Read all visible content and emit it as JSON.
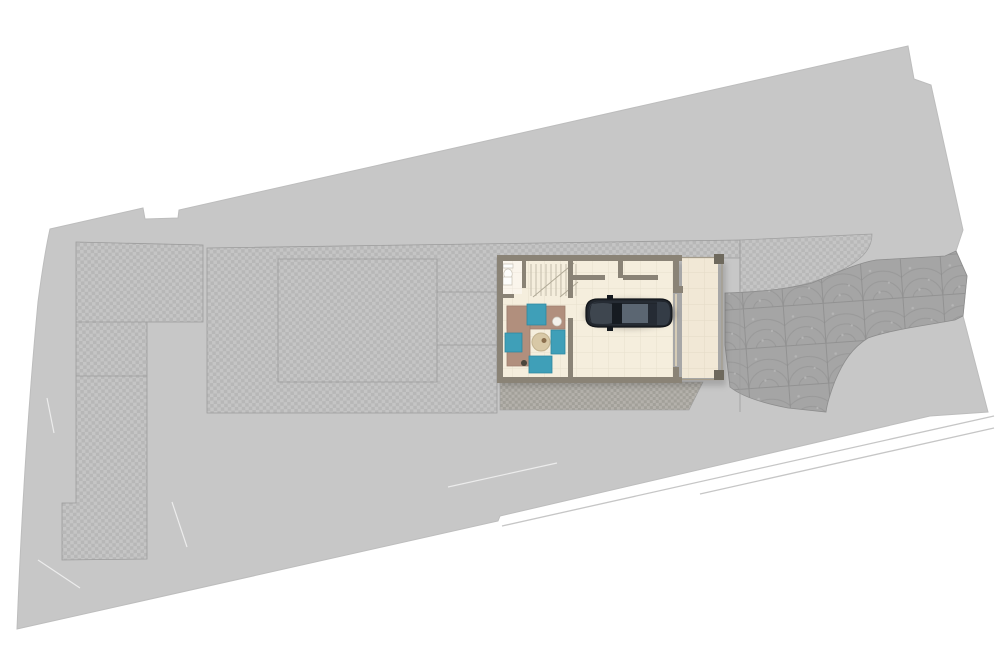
{
  "scene": {
    "width": 1000,
    "height": 666,
    "kind": "architectural-site-plan-top-view"
  },
  "colors": {
    "background": "#ffffff",
    "site": "#c7c7c7",
    "site_edge": "#bdbdbd",
    "paver_light": "#c5c5c5",
    "paver_dark": "#b7b7b7",
    "paver_strip_light": "#b3b0aa",
    "paver_strip_dark": "#a19e97",
    "cobble_base": "#a5a5a5",
    "cobble_line": "#8d8d8d",
    "cobble_dot": "#b5b5b5",
    "outline": "#9c9c9c",
    "sidewalk_line": "#c6c6c6",
    "scratch": "#efefef",
    "wall": "#8a8376",
    "floor": "#f5eedd",
    "floor_bath": "#faf5ec",
    "floor_carport": "#f1e8d6",
    "tile_line": "rgba(120,100,70,0.10)",
    "post": "#6e695d",
    "trim": "#a59d8c",
    "garage_door": "#d6ccb6",
    "stair_line": "#c3bcab",
    "stair_break": "#b0a996",
    "fixture_fill": "#fdfdfb",
    "fixture_stroke": "#c9c4b8",
    "shadow": "rgba(0,0,0,0.16)",
    "sofa": "#b18f7d",
    "sofa_edge": "#9d7f6e",
    "teal": "#3f9fb8",
    "teal_edge": "#2f87a0",
    "table": "#d8c8a6",
    "table_edge": "#c2b28f",
    "vase": "#f4f1ea",
    "accent_dark": "#4a463c",
    "deco": "#8b6f4e",
    "car_shadow": "rgba(0,0,0,0.22)",
    "car_body": "#21262d",
    "car_outline": "#121519",
    "car_inner": "#39414b",
    "car_hood": "#3e464f",
    "car_glass": "#161b21",
    "car_roof": "#5b6672",
    "car_rear_glass": "#252b34",
    "car_trunk": "#343c46",
    "car_mirror": "#14181d"
  },
  "geometry": {
    "site": "M50,229 L143,208 L145,219 L178,218 L179,210 L908,46 L914,79 L931,85 L963,230 L956,251 L967,276 L963,316 L988,412 L930,416 L500,516 L498,521 L17,629 Q24,450 38,302 Q44,256 50,229 Z",
    "paved_left": "M76,242 L203,245 L203,322 L147,322 L147,559 L62,560 L62,503 L76,503 Z",
    "paved_left_lines": "M76,322 L147,322 M76,376 L147,376",
    "paved_main": "M207,248 L740,240 L740,258 L497,258 L497,413 L207,413 Z",
    "paved_band_right": "M740,240 L872,234 C872,252 858,262 836,273 C812,285 772,292 740,293 Z",
    "paved_strip_garage": "M500,382 L703,382 L689,410 L500,410 Z",
    "cobble_driveway": "M725,293 C762,292 792,288 812,283 C838,272 858,263 876,260 L945,256 L956,251 L967,276 L963,316 L955,320 C922,326 890,330 868,338 C852,348 843,362 835,381 C830,394 827,404 826,412 L788,408 C762,403 741,396 730,387 L725,345 Z",
    "outline_inner_rect": "M278,259 L437,259 L437,382 L278,382 Z M437,292 L500,292 M437,345 L500,345",
    "outline_driveway_line": "M740,241 L740,412",
    "sidewalk_lines": "M502,526 L994,416 M700,494 L994,428",
    "scratch_lines": "M448,487 L557,463 M38,560 L80,588 M172,502 L187,547 M47,398 L54,433",
    "house_shadow": "M500,262 L726,262 L726,386 L500,386 Z",
    "floor_main": "M502,261 L673,261 L673,377 L502,377 Z",
    "floor_bath": "M503,261 L522,261 L522,294 L503,294 Z",
    "floor_carport": "M682,258 L718,258 L718,378 L682,378 Z",
    "carport_trim": "M682,257.5 L724,257.5 M722,257.5 L722,380 M682,379.5 L724,379.5",
    "carport_posts": "M714,254 L724,254 L724,264 L714,264 Z M714,370 L724,370 L724,380 L714,380 Z",
    "garage_door_line": "M676,294 L676,366",
    "stair_treads": "M531,264 L531,296 M536,264 L536,296 M541,264 L541,296 M546,264 L546,296 M551,264 L551,296 M556,264 L556,296 M561,264 L561,296 M566,264 L566,296 M571,264 L571,296 M576,264 L576,296",
    "stair_break": "M533,297 L574,263 M560,297 L578,282",
    "walls": "M497,255 L682,255 L682,261 L497,261 Z M497,261 L503,261 L503,383 L497,383 Z M497,377 L682,377 L682,383 L497,383 Z M673,261 L679,261 L679,290 L673,290 Z M673,286 L683,286 L683,293 L673,293 Z M673,367 L679,367 L679,377 L673,377 Z M568,261 L573,261 L573,298 L568,298 Z M568,318 L573,318 L573,377 L568,377 Z M522,261 L526,261 L526,288 L522,288 Z M502,294 L514,294 L514,298 L502,298 Z M573,275 L605,275 L605,280 L573,280 Z M618,261 L623,261 L623,278 L618,278 Z M623,275 L658,275 L658,280 L623,280 Z",
    "toilet_tank": "M503,264 L513,264 L513,268 L503,268 Z",
    "toilet_bowl": "M508,269 a4.2,5 0 1 0 0.01,0 Z",
    "sink": "M503,277 L512,277 L512,285 L503,285 Z"
  },
  "furniture": [
    {
      "name": "sofa-top-arm",
      "d": "M507,306 L565,306 L565,329 L507,329 Z",
      "fill": "sofa",
      "stroke": "sofa_edge",
      "sw": 0.8
    },
    {
      "name": "sofa-left-arm",
      "d": "M507,306 L530,306 L530,366 L507,366 Z",
      "fill": "sofa",
      "stroke": "sofa_edge",
      "sw": 0.8
    },
    {
      "name": "armchair-teal-top",
      "d": "M527,304 L546,304 L546,325 L527,325 Z",
      "fill": "teal",
      "stroke": "teal_edge",
      "sw": 0.8
    },
    {
      "name": "cushion-teal-left",
      "d": "M505,333 L522,333 L522,352 L505,352 Z",
      "fill": "teal",
      "stroke": "teal_edge",
      "sw": 0.8
    },
    {
      "name": "pouf-teal-right",
      "d": "M551,330 L565,330 L565,354 L551,354 Z",
      "fill": "teal",
      "stroke": "teal_edge",
      "sw": 0.8
    },
    {
      "name": "armchair-teal-bottom",
      "d": "M529,356 L552,356 L552,373 L529,373 Z",
      "fill": "teal",
      "stroke": "teal_edge",
      "sw": 0.8
    },
    {
      "name": "coffee-table-round",
      "d": "M541,333 a9,9 0 1 0 0.01,0 Z",
      "fill": "table",
      "stroke": "table_edge",
      "sw": 1
    },
    {
      "name": "table-decor",
      "d": "M544,338 a2.5,2.5 0 1 0 0.01,0 Z",
      "fill": "deco"
    },
    {
      "name": "vase-white",
      "d": "M557,317 a4.5,4.5 0 1 0 0.01,0 Z",
      "fill": "vase",
      "stroke": "fixture_stroke",
      "sw": 0.7
    },
    {
      "name": "floor-decor-dark",
      "d": "M524,360 a3,3 0 1 0 0.01,0 Z",
      "fill": "accent_dark"
    }
  ],
  "car": [
    {
      "name": "car-shadow",
      "d": "M584,314 a46,15 0 1 0 92,0 a46,15 0 1 0 -92,0 Z",
      "fill": "car_shadow",
      "blur": true
    },
    {
      "name": "car-body",
      "d": "M598,299 L660,299 Q672,299 672,310 L672,317 Q672,327 660,327 L598,327 Q586,327 586,317 L586,310 Q586,299 598,299 Z",
      "fill": "car_body",
      "stroke": "car_outline",
      "sw": 1.2
    },
    {
      "name": "car-body-inner-line",
      "d": "M599,302 L659,302 Q669,302 669,311 L669,316 Q669,324 659,324 L599,324 Q589,324 589,316 L589,311 Q589,302 599,302 Z",
      "fill": "none",
      "stroke": "car_inner",
      "sw": 0.8,
      "opacity": 0.65
    },
    {
      "name": "car-hood",
      "d": "M592,304 Q604,302 612,304 L612,323 Q604,325 592,323 Q588,313 592,304 Z",
      "fill": "car_hood"
    },
    {
      "name": "car-windshield",
      "d": "M612,303 L622,303 L622,324 L612,324 Z",
      "fill": "car_glass"
    },
    {
      "name": "car-roof",
      "d": "M622,304 L648,304 L648,323 L622,323 Z",
      "fill": "car_roof"
    },
    {
      "name": "car-rear-window",
      "d": "M648,304 L657,304 L657,323 L648,323 Z",
      "fill": "car_rear_glass"
    },
    {
      "name": "car-trunk",
      "d": "M657,302 L664,302 Q670,302 670,313 Q670,325 664,325 L657,325 Z",
      "fill": "car_trunk"
    },
    {
      "name": "car-mirror-top",
      "d": "M607,295 L613,295 L613,299 L607,299 Z",
      "fill": "car_mirror"
    },
    {
      "name": "car-mirror-bottom",
      "d": "M607,327 L613,327 L613,331 L607,331 Z",
      "fill": "car_mirror"
    }
  ]
}
